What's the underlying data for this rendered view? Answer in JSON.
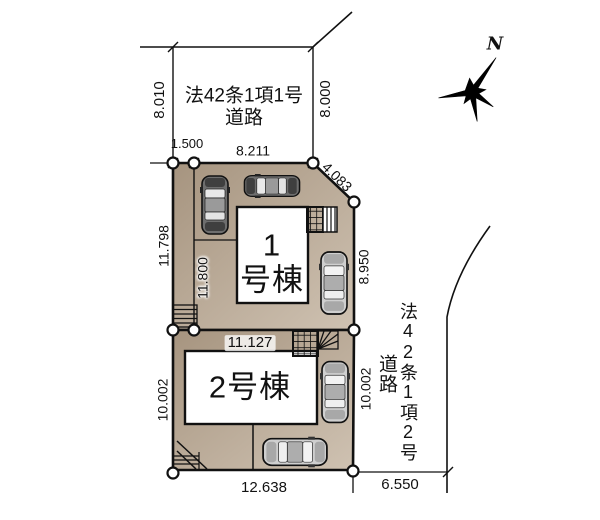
{
  "colors": {
    "lot_fill_dark": "#a6947f",
    "lot_fill_light": "#cfc2b2",
    "building_fill": "#ffffff",
    "line": "#111111"
  },
  "compass": {
    "north_label": "N"
  },
  "roads": {
    "top": {
      "line1": "法42条1項1号",
      "line2": "道路"
    },
    "right": {
      "name": "法42条1項2号",
      "suffix": "道路"
    }
  },
  "buildings": {
    "b1": {
      "number": "1",
      "suffix": "号棟"
    },
    "b2": {
      "label": "2号棟"
    }
  },
  "dimensions": {
    "road_top_left": "8.010",
    "road_top_right": "8.000",
    "setback_top": "1.500",
    "lot1_top_edge": "8.211",
    "corner_cut": "4.083",
    "lot1_left_outer": "11.798",
    "lot1_left_inner": "11.800",
    "lot1_right_edge": "8.950",
    "lot2_top_edge": "11.127",
    "lot2_left_edge": "10.002",
    "lot2_right_edge": "10.002",
    "lot2_bottom_edge": "12.638",
    "road_bottom_right": "6.550"
  }
}
